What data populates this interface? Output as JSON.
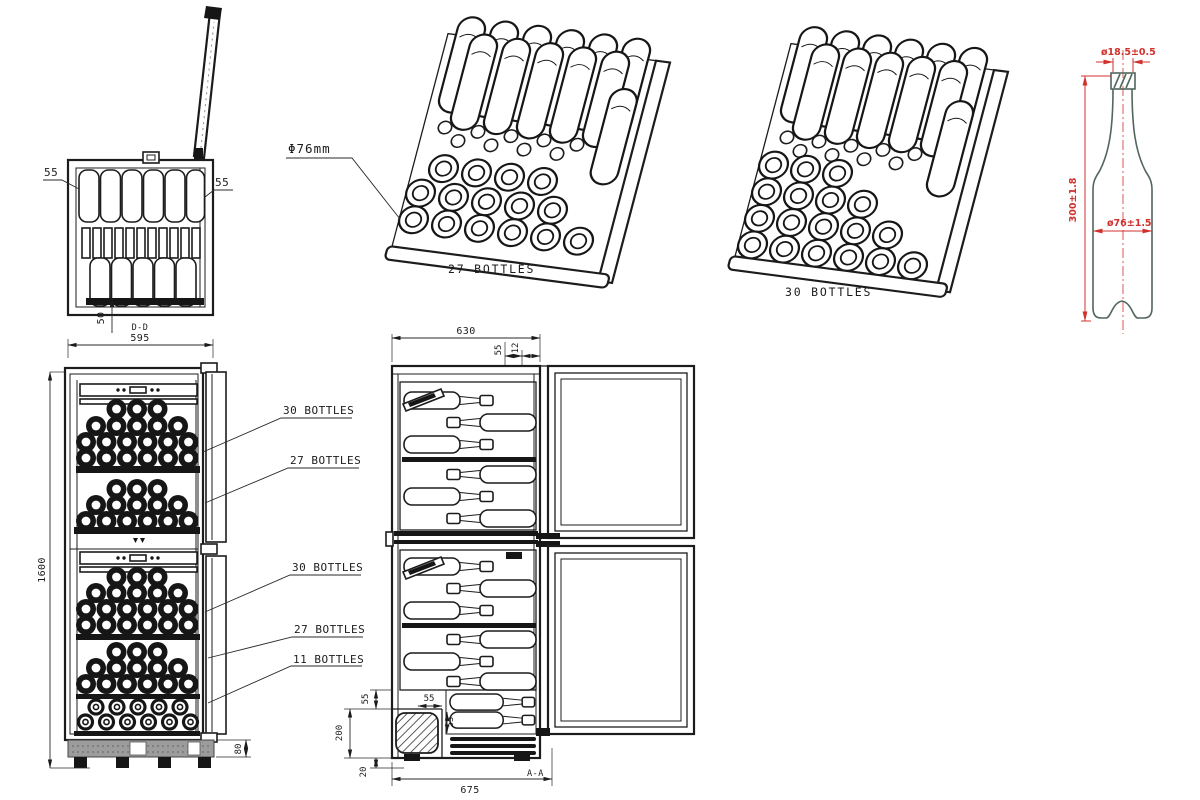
{
  "colors": {
    "line": "#1c1c1c",
    "dimension_red": "#d0312d",
    "bottle_outline_green": "#52665c",
    "base_gray": "#9c9c9c"
  },
  "top_view": {
    "section_label": "D-D",
    "dim_left": "55",
    "dim_right": "55",
    "dim_bottom": "50"
  },
  "front_view": {
    "dim_width": "595",
    "dim_height": "1600",
    "dim_base": "80",
    "callouts": [
      "30 BOTTLES",
      "27 BOTTLES",
      "30 BOTTLES",
      "27 BOTTLES",
      "11 BOTTLES"
    ]
  },
  "iso_27": {
    "caption": "27 BOTTLES"
  },
  "iso_30": {
    "caption": "30 BOTTLES"
  },
  "phi_callout": {
    "label": "Φ76mm"
  },
  "side_view": {
    "section_label": "A-A",
    "dim_depth": "630",
    "dim_top_a": "55",
    "dim_top_b": "12",
    "dim_left_top": "55",
    "dim_left_mid": "200",
    "dim_left_bottom": "20",
    "dim_step_h": "55",
    "dim_step_v": "55",
    "dim_bottom": "675"
  },
  "bottle_spec": {
    "dim_neck_dia": "ø18.5±0.5",
    "dim_height": "300±1.8",
    "dim_body_dia": "ø76±1.5"
  }
}
